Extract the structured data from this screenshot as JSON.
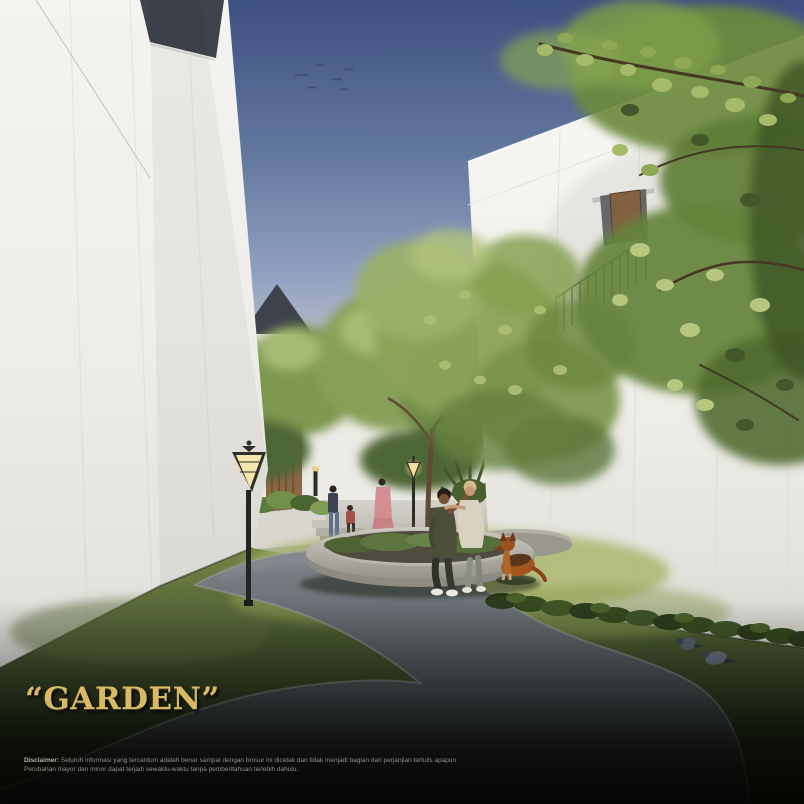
{
  "title": {
    "text": "“GARDEN”"
  },
  "disclaimer": {
    "label": "Disclaimer:",
    "line1": " Seluruh informasi yang tercantum adalah benar sampai dengan brosur ini dicetak dan tidak menjadi bagian dari perjanjian tertulis apapun",
    "line2": "Perubahan mayor dan minor dapat terjadi sewaktu-waktu tanpa pemberitahuan terlebih dahulu."
  },
  "scene": {
    "colors": {
      "title_gold": "#d9b963",
      "sky_top": "#3d5082",
      "sky_horizon": "#f7f1de",
      "wall_white": "#f6f5f2",
      "roof_dark": "#3e434b",
      "grass_sunlit": "#a8b465",
      "grass_shadow": "#1d2516",
      "path_grey": "#565c62",
      "lamp_glow": "#ffedb0",
      "wood_door": "#8a6745",
      "dog_fur": "#a2551d",
      "foliage_green": "#6b8a3d"
    }
  }
}
